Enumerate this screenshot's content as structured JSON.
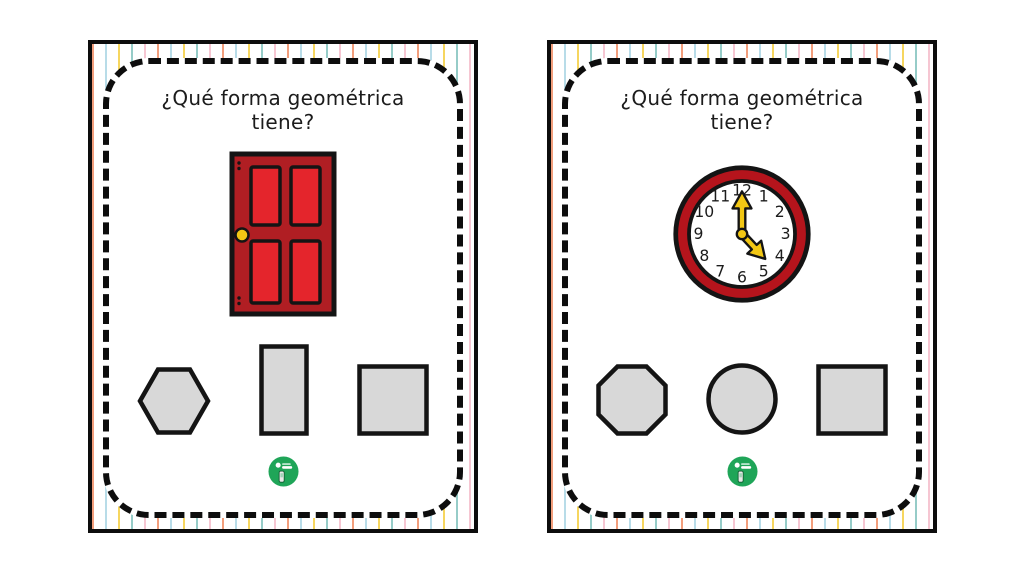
{
  "cards": [
    {
      "title_line1": "¿Qué forma geométrica",
      "title_line2": "tiene?",
      "figure": "red-door",
      "options": [
        "hexagon",
        "rectangle",
        "square"
      ]
    },
    {
      "title_line1": "¿Qué forma geométrica",
      "title_line2": "tiene?",
      "figure": "wall-clock-minute-hand-on-12-hour-hand-between-4-and-5",
      "options": [
        "octagon",
        "circle",
        "square"
      ]
    }
  ],
  "clock": {
    "numbers": [
      "12",
      "1",
      "2",
      "3",
      "4",
      "5",
      "6",
      "7",
      "8",
      "9",
      "10",
      "11"
    ]
  },
  "colors": {
    "door_body": "#B01E23",
    "door_panel": "#E4252C",
    "door_knob": "#F2C714",
    "clock_ring": "#B5141C",
    "clock_hands": "#F2C714",
    "option_fill": "#D8D8D8",
    "outline": "#141414",
    "logo_green": "#1FA558",
    "stripe_palette": [
      "#F29E7C",
      "#B8DCE8",
      "#F6D65F",
      "#96CCC8",
      "#F6C6D2"
    ]
  }
}
